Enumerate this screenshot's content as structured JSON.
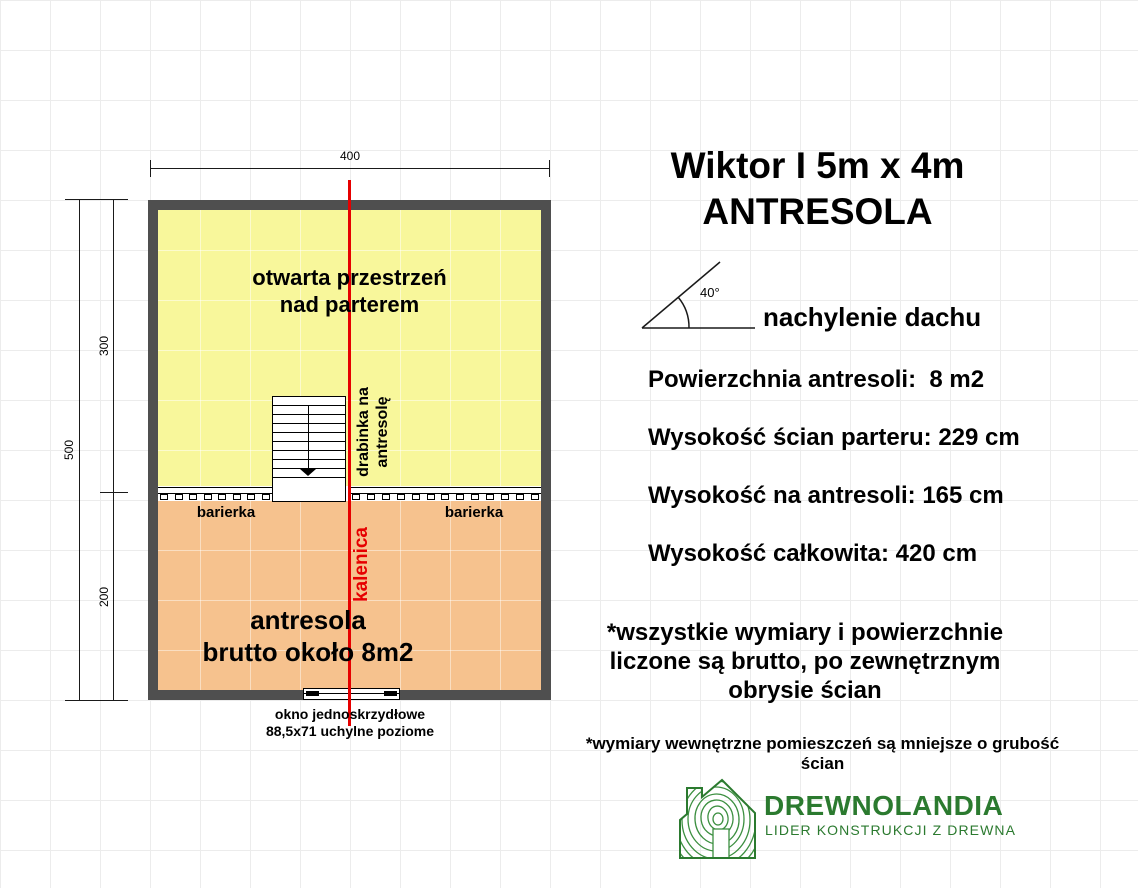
{
  "plan": {
    "dimensions": {
      "top_width": "400",
      "left_total": "500",
      "left_upper": "300",
      "left_lower": "200"
    },
    "open_space": {
      "line1": "otwarta przestrzeń",
      "line2": "nad parterem"
    },
    "ladder_label": {
      "line1": "drabinka na",
      "line2": "antresolę"
    },
    "barrier_left_label": "barierka",
    "barrier_right_label": "barierka",
    "ridge_label": "kalenica",
    "mezzanine": {
      "line1": "antresola",
      "line2": "brutto około 8m2"
    },
    "window": {
      "line1": "okno jednoskrzydłowe",
      "line2": "88,5x71 uchylne poziome"
    }
  },
  "info": {
    "title": {
      "line1": "Wiktor I 5m x 4m",
      "line2": "ANTRESOLA"
    },
    "roof": {
      "angle": "40°",
      "label": "nachylenie dachu"
    },
    "specs": [
      "Powierzchnia antresoli:  8 m2",
      "Wysokość ścian parteru: 229 cm",
      "Wysokość na antresoli: 165 cm",
      "Wysokość całkowita: 420 cm"
    ],
    "note_primary": {
      "line1": "*wszystkie wymiary i powierzchnie",
      "line2": "liczone są brutto, po zewnętrznym",
      "line3": "obrysie ścian"
    },
    "note_secondary": "*wymiary wewnętrzne pomieszczeń są mniejsze o grubość ścian"
  },
  "branding": {
    "name": "DREWNOLANDIA",
    "tagline": "LIDER KONSTRUKCJI Z DREWNA"
  },
  "colors": {
    "open_space_fill": "#f8f79b",
    "mezzanine_fill": "#f6c28e",
    "wall": "#4f4f4f",
    "ridge_red": "#e60000",
    "brand_green": "#2b7a2f"
  }
}
